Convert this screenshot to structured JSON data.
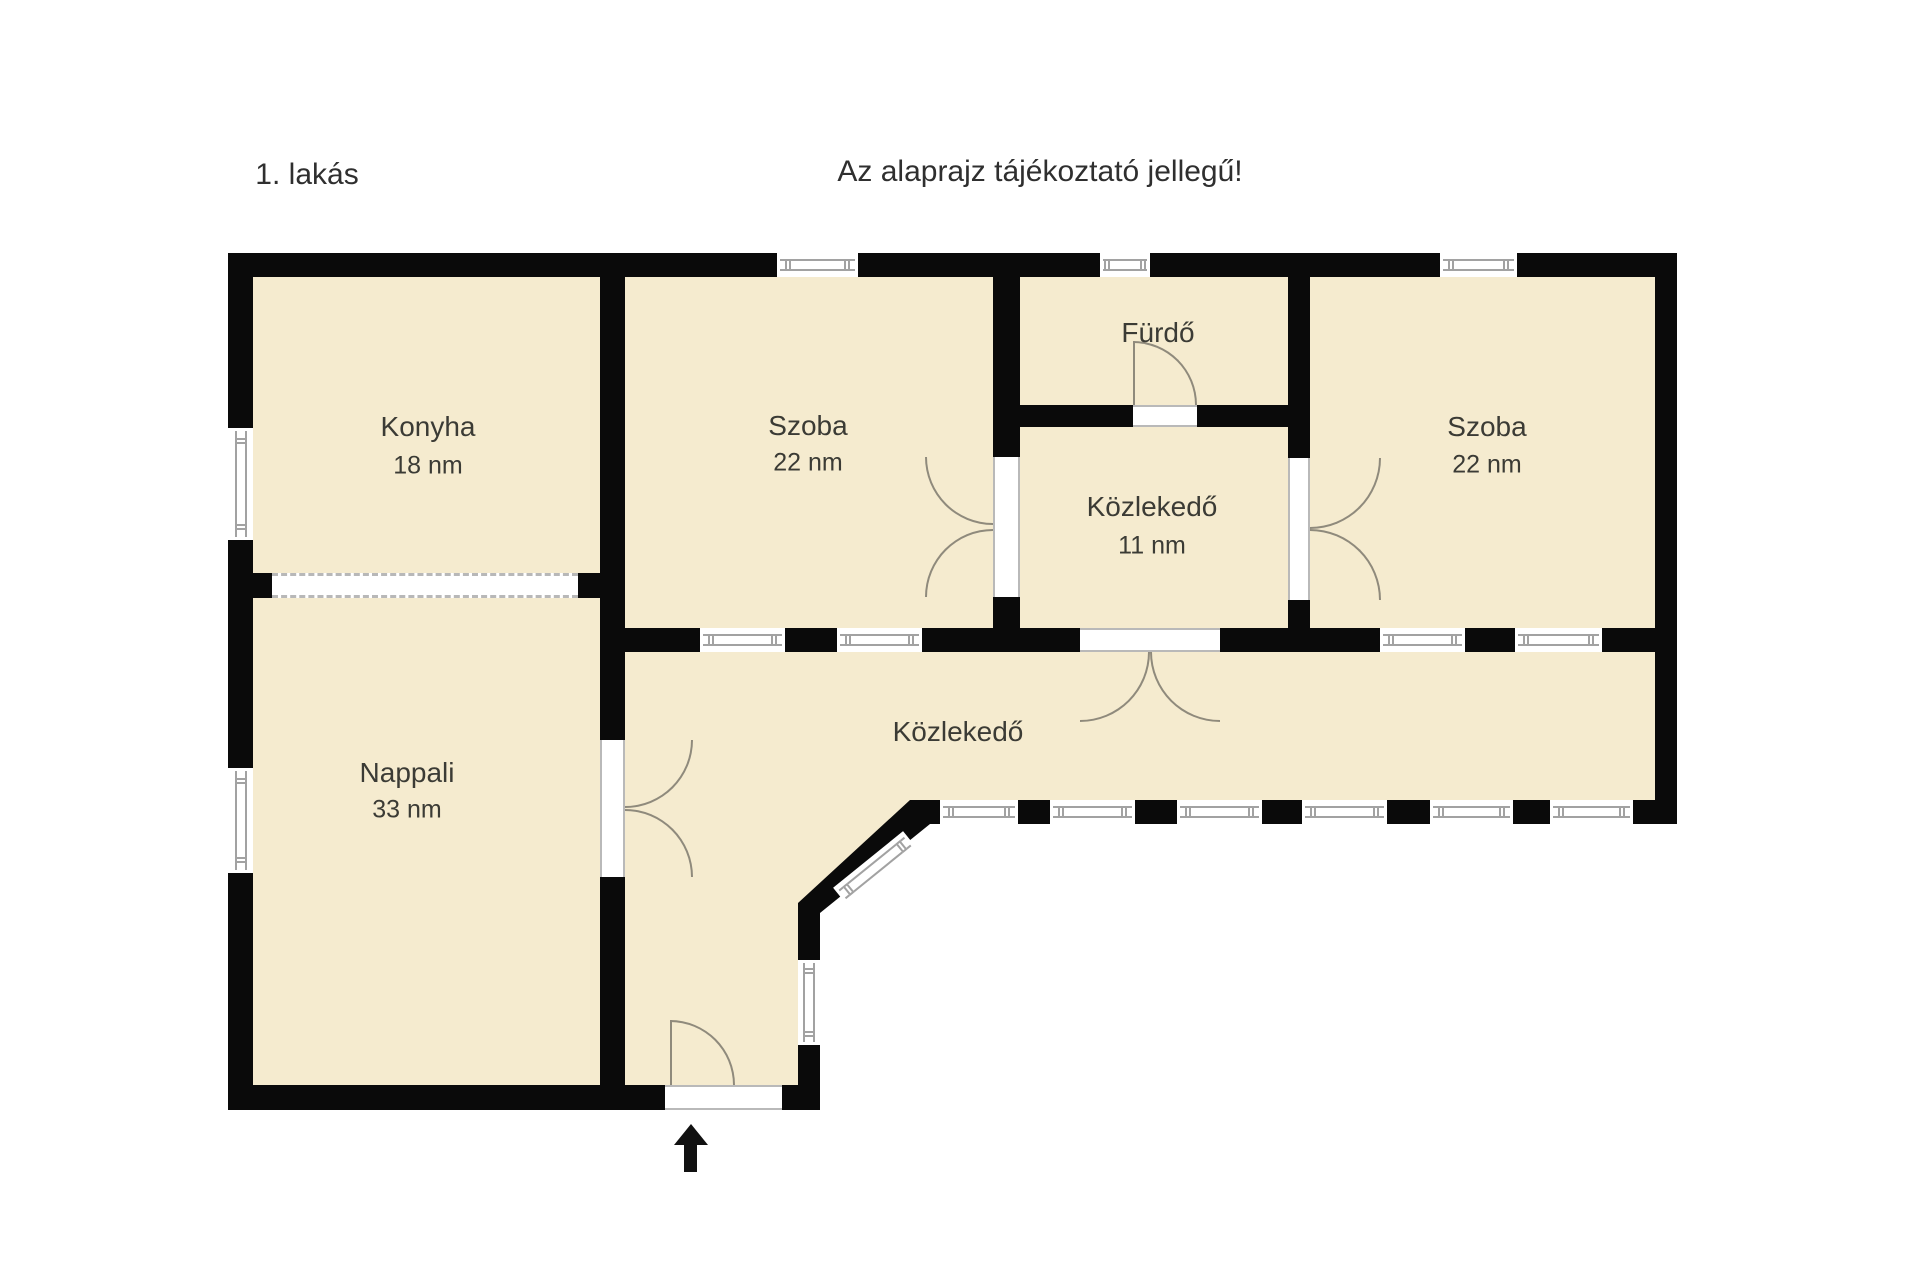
{
  "header": {
    "unit_label": "1. lakás",
    "disclaimer": "Az alaprajz tájékoztató jellegű!"
  },
  "rooms": {
    "konyha": {
      "name": "Konyha",
      "area": "18 nm"
    },
    "szoba_middle": {
      "name": "Szoba",
      "area": "22 nm"
    },
    "furdo": {
      "name": "Fürdő"
    },
    "kozlekedo_small": {
      "name": "Közlekedő",
      "area": "11 nm"
    },
    "szoba_right": {
      "name": "Szoba",
      "area": "22 nm"
    },
    "nappali": {
      "name": "Nappali",
      "area": "33 nm"
    },
    "kozlekedo_main": {
      "name": "Közlekedő"
    }
  },
  "compass": {
    "icon": "north-arrow"
  },
  "colors": {
    "floor_fill": "#f5ebcf",
    "wall": "#0a0a0a",
    "window_frame": "#a2a2a2",
    "door_arc": "#8f8a7c",
    "text": "#3b3b35",
    "background": "#ffffff"
  }
}
